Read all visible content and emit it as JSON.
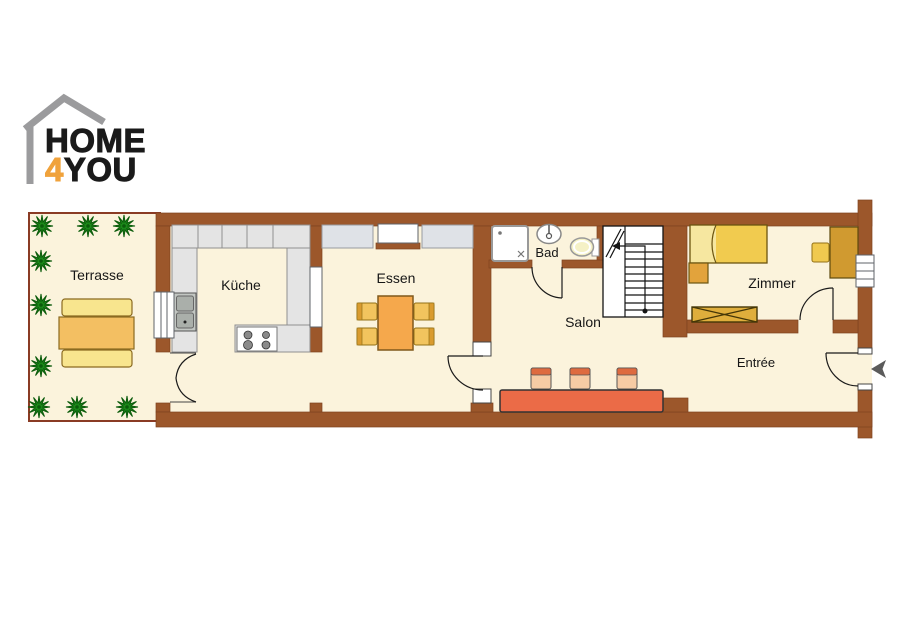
{
  "logo": {
    "line1": "HOME",
    "line2_accent": "4",
    "line2_rest": "YOU",
    "accent_color": "#F0A23B",
    "text_color": "#1A1A1A",
    "house_outline_color": "#9B9B9D"
  },
  "rooms": {
    "terrasse": "Terrasse",
    "kueche": "Küche",
    "essen": "Essen",
    "bad": "Bad",
    "salon": "Salon",
    "zimmer": "Zimmer",
    "entree": "Entrée"
  },
  "colors": {
    "wall": "#9C572B",
    "floor": "#FBF3DC",
    "terrace_border": "#8A3B24",
    "counter_gray": "#E4E4E4",
    "sideboard_gray": "#DFE2E7",
    "sofa_orange": "#EB6B47",
    "cushion_peach": "#F6CBA4",
    "dining_table_orange": "#F5A84C",
    "chair_yellow": "#F2C45E",
    "bed_yellow": "#F1CB4F",
    "pillow_yellow": "#F6E7A0",
    "bench_yellow": "#F8E58E",
    "terrace_table_orange": "#F3BF62",
    "desk_gold": "#D09A30",
    "dresser_gold": "#DFAE3C",
    "nightstand_orange": "#E2A33C",
    "toilet_seat_yellow": "#F5F1C6",
    "plant_green": "#1C8A1A",
    "entry_arrow_gray": "#5B5B5B"
  },
  "symbols": {
    "plant": "star-burst-plant",
    "stairs": "staircase-with-walk-line",
    "entry": "left-pointing-entrance-arrow"
  }
}
